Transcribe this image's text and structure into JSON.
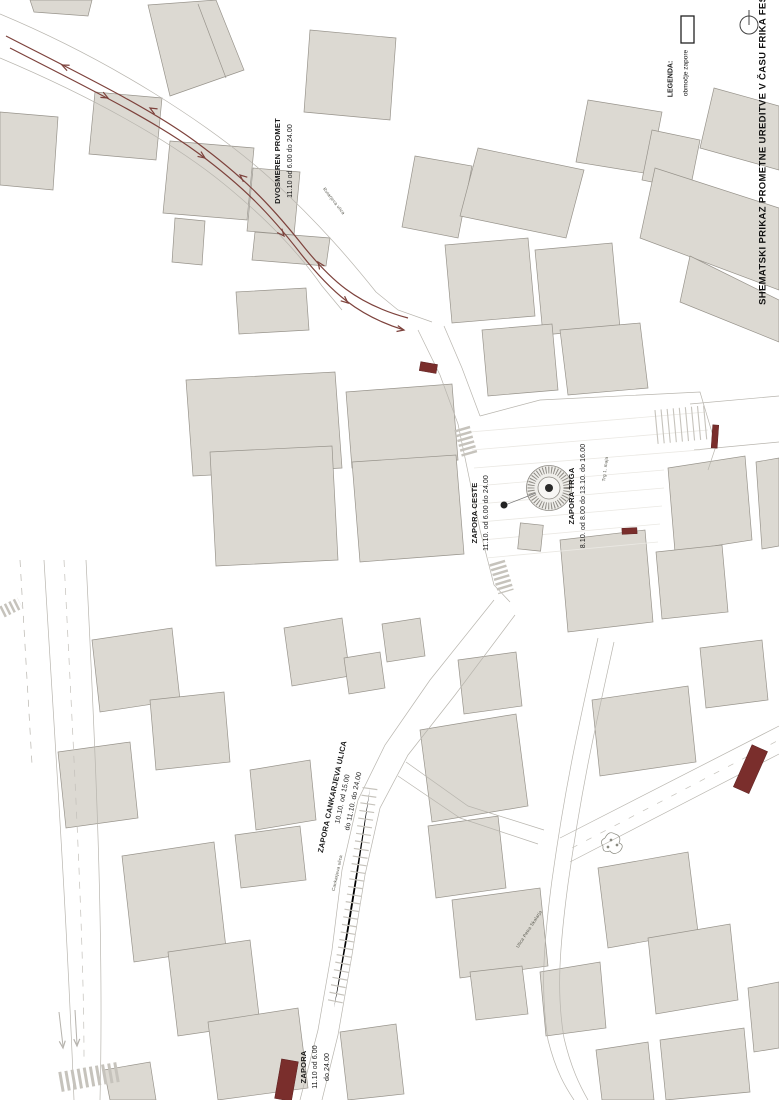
{
  "canvas": {
    "width": 779,
    "height": 1100,
    "background": "#ffffff"
  },
  "colors": {
    "building_fill": "#dcd9d2",
    "building_stroke": "#98948c",
    "road_line": "#b8b5ae",
    "closure_red": "#7a2e2c",
    "two_way_arrow_red": "#7d423c",
    "label_text": "#1a1a1a",
    "street_text": "#55554b"
  },
  "header": {
    "title": "SHEMATSKI PRIKAZ PROMETNE UREDITVE V ČASU FRIKA FESTA"
  },
  "legend": {
    "heading": "LEGENDA:",
    "item_label": "območje zapore",
    "swatch": "outline-rectangle",
    "north_icon": "compass-circle"
  },
  "labels": {
    "two_way": {
      "title": "DVOSMEREN PROMET",
      "schedule": "11.10 od 6.00 do 24.00"
    },
    "road_closure": {
      "title": "ZAPORA CESTE",
      "schedule": "11.10. od 6.00 do 24.00"
    },
    "square_closure": {
      "title": "ZAPORA TRGA",
      "schedule": "8.10. od 8.00 do 13.10. do 16.00"
    },
    "cankarjeva_closure": {
      "title": "ZAPORA CANKARJEVA ULICA",
      "schedule_line1": "10.10. od 15.00",
      "schedule_line2": "do 11.10. do 24.00"
    },
    "south_closure": {
      "title": "ZAPORA",
      "schedule_line1": "11.10 od 6.00",
      "schedule_line2": "do 24.00"
    }
  },
  "streets": {
    "north_street": "Rutarjeva ulica",
    "square": "Trg 1. maja",
    "cankarjeva": "Cankarjeva ulica",
    "south_street": "Ulica Petra Skalarja"
  }
}
